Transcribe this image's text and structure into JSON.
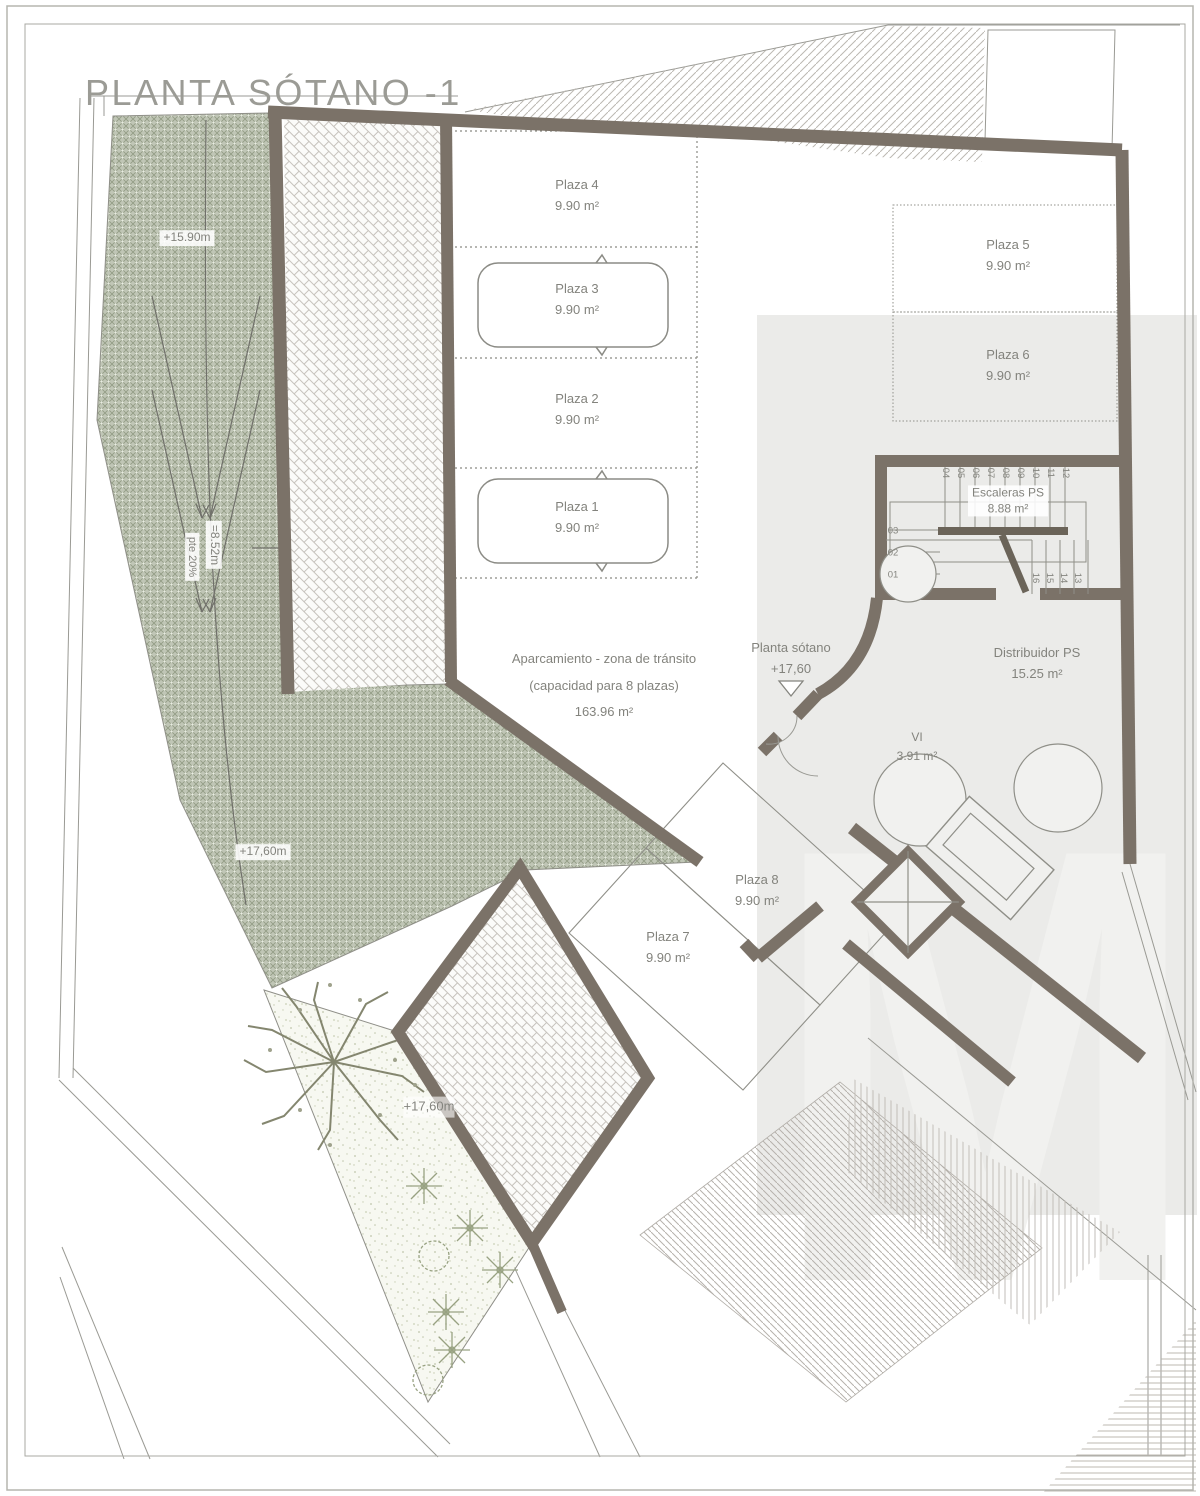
{
  "title": "PLANTA SÓTANO -1",
  "watermark": {
    "letter": "M"
  },
  "plazas": {
    "plaza_1": {
      "label": "Plaza 1",
      "area": "9.90 m²"
    },
    "plaza_2": {
      "label": "Plaza 2",
      "area": "9.90 m²"
    },
    "plaza_3": {
      "label": "Plaza 3",
      "area": "9.90 m²"
    },
    "plaza_4": {
      "label": "Plaza 4",
      "area": "9.90 m²"
    },
    "plaza_5": {
      "label": "Plaza 5",
      "area": "9.90 m²"
    },
    "plaza_6": {
      "label": "Plaza 6",
      "area": "9.90 m²"
    },
    "plaza_7": {
      "label": "Plaza 7",
      "area": "9.90 m²"
    },
    "plaza_8": {
      "label": "Plaza 8",
      "area": "9.90 m²"
    }
  },
  "aparcamiento": {
    "line1": "Aparcamiento - zona de tránsito",
    "line2": "(capacidad para 8 plazas)",
    "area": "163.96 m²"
  },
  "rooms": {
    "escaleras": {
      "label": "Escaleras PS",
      "area": "8.88 m²"
    },
    "distribuidor": {
      "label": "Distribuidor PS",
      "area": "15.25 m²"
    },
    "vi": {
      "label": "VI",
      "area": "3.91 m²"
    }
  },
  "marker": {
    "label": "Planta sótano",
    "level": "+17,60"
  },
  "levels": {
    "ramp_top": "+15.90m",
    "ramp_mid": "+17,60m",
    "garden": "+17,60m"
  },
  "ramp": {
    "length": "=8.52m",
    "slope": "pte 20%"
  },
  "stairs": {
    "top": [
      "04",
      "05",
      "06",
      "07",
      "08",
      "09",
      "10",
      "11",
      "12"
    ],
    "left": [
      "03",
      "02",
      "01"
    ],
    "bottom": [
      "16",
      "15",
      "14",
      "13"
    ]
  },
  "colors": {
    "wall": "#7b7268",
    "ramp_green": "#c0c6b6",
    "line": "#8f8f88",
    "paper": "#ffffff"
  }
}
